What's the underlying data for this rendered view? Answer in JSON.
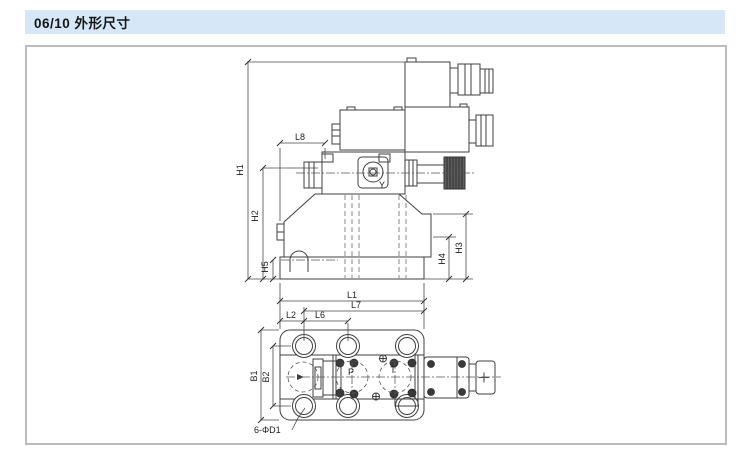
{
  "header": {
    "title": "06/10 外形尺寸"
  },
  "side_view": {
    "dim_labels": {
      "h1": "H1",
      "h2": "H2",
      "h5": "H5",
      "h4": "H4",
      "h3": "H3",
      "l8": "L8"
    },
    "port_label": "Y"
  },
  "top_view": {
    "dim_labels": {
      "l1": "L1",
      "l7": "L7",
      "l2": "L2",
      "l6": "L6",
      "b1": "B1",
      "b2": "B2"
    },
    "port_labels": {
      "p": "P",
      "t": "T"
    },
    "bolt_hole_note": "6-ΦD1"
  },
  "colors": {
    "header_bg": "#d6e8f7",
    "panel_border": "#bcbcbc",
    "line": "#3f3f3f",
    "knob_fill": "#5f5f5f"
  }
}
